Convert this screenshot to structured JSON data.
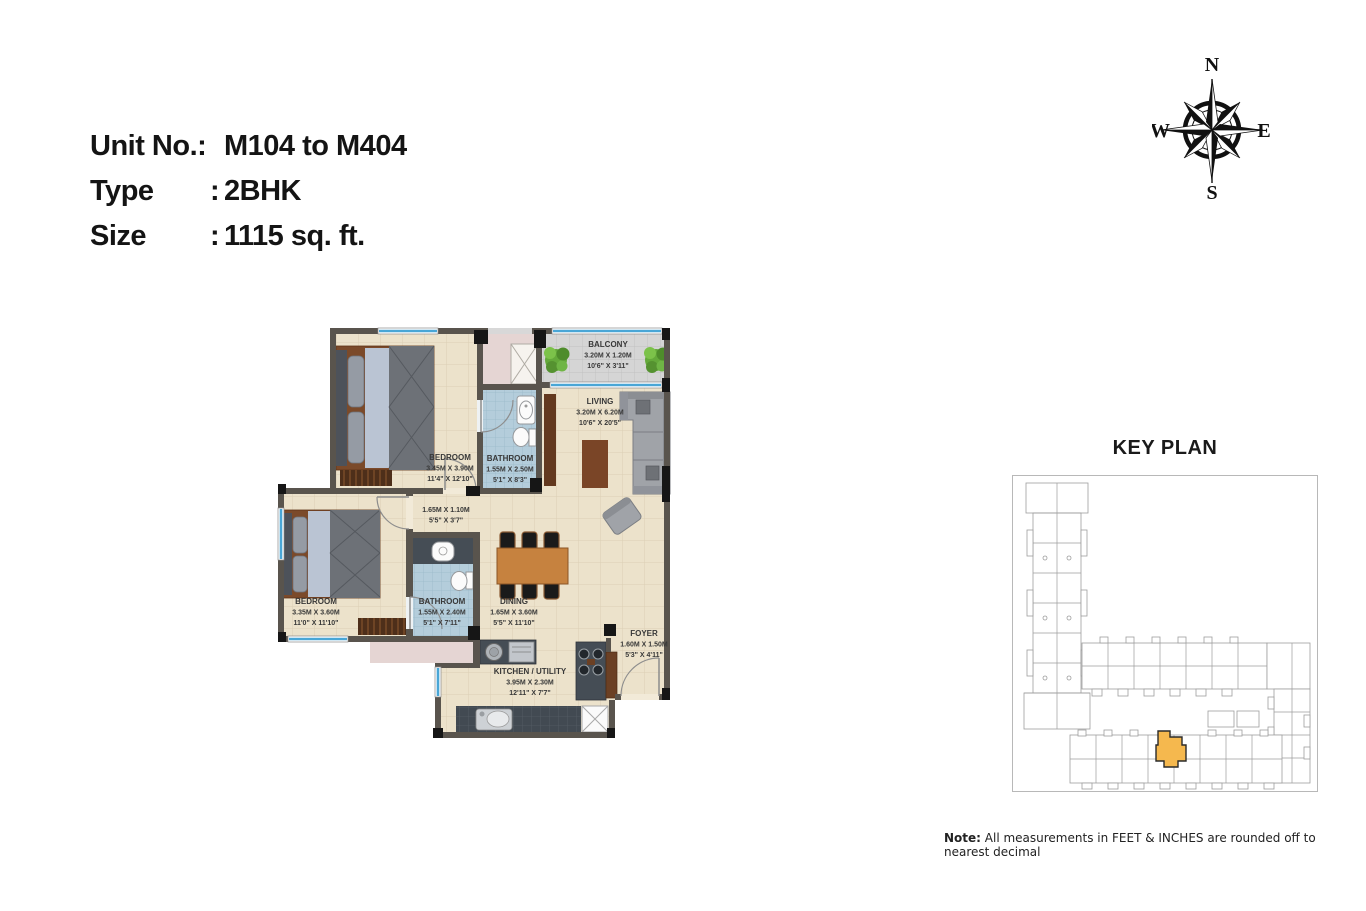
{
  "header": {
    "unit_label": "Unit No.:",
    "unit_value": "M104 to M404",
    "type_label": "Type",
    "type_value": "2BHK",
    "size_label": "Size",
    "size_value": "1115 sq. ft.",
    "colon": ":"
  },
  "compass": {
    "north": "N",
    "south": "S",
    "east": "E",
    "west": "W"
  },
  "floorplan": {
    "rooms": {
      "bedroom1": {
        "name": "BEDROOM",
        "m": "3.45M X 3.90M",
        "ft": "11'4\" X 12'10\""
      },
      "bathroom1": {
        "name": "BATHROOM",
        "m": "1.55M X 2.50M",
        "ft": "5'1\" X 8'3\""
      },
      "balcony": {
        "name": "BALCONY",
        "m": "3.20M X 1.20M",
        "ft": "10'6\" X 3'11\""
      },
      "living": {
        "name": "LIVING",
        "m": "3.20M X 6.20M",
        "ft": "10'6\" X 20'5\""
      },
      "passage": {
        "m": "1.65M X 1.10M",
        "ft": "5'5\" X 3'7\""
      },
      "bedroom2": {
        "name": "BEDROOM",
        "m": "3.35M X 3.60M",
        "ft": "11'0\" X 11'10\""
      },
      "bathroom2": {
        "name": "BATHROOM",
        "m": "1.55M X 2.40M",
        "ft": "5'1\" X 7'11\""
      },
      "dining": {
        "name": "DINING",
        "m": "1.65M X 3.60M",
        "ft": "5'5\" X 11'10\""
      },
      "kitchen": {
        "name": "KITCHEN / UTILITY",
        "m": "3.95M X 2.30M",
        "ft": "12'11\" X 7'7\""
      },
      "foyer": {
        "name": "FOYER",
        "m": "1.60M X 1.50M",
        "ft": "5'3\" X 4'11\""
      }
    }
  },
  "keyplan": {
    "title": "KEY PLAN"
  },
  "note": {
    "label": "Note:",
    "text": " All measurements in FEET & INCHES are rounded off to nearest decimal"
  },
  "colors": {
    "wall": "#59544d",
    "floor": "#ece2cb",
    "bathroom_tile": "#b4cddb",
    "balcony_tile": "#d5d5d5",
    "window_blue": "#6cc0e5",
    "keyplan_highlight": "#f5b84e",
    "wood": "#c6823f",
    "text": "#383838"
  }
}
